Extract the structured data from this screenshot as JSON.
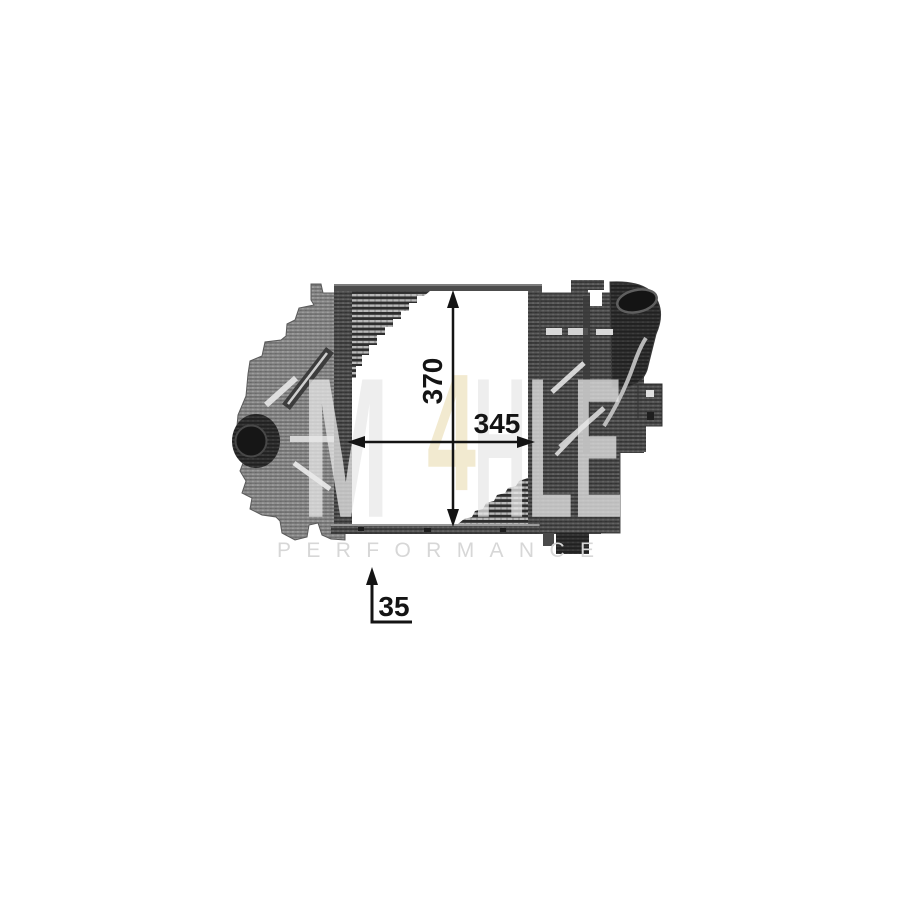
{
  "figure": {
    "subject": "Grayscale halftone product photo of an intercooler (charge air cooler) with dimension arrows",
    "annotation_color": "#141414",
    "dimensions": {
      "height": "370",
      "width": "345",
      "depth": "35"
    }
  },
  "watermark": {
    "brand_m": "M",
    "brand_accent": "4",
    "brand_rest": "HLE",
    "tagline": "PERFORMANCE",
    "gray_color": "#e9e9e9",
    "accent_color": "#f1e8cc",
    "tagline_color": "#d7d7d7"
  }
}
